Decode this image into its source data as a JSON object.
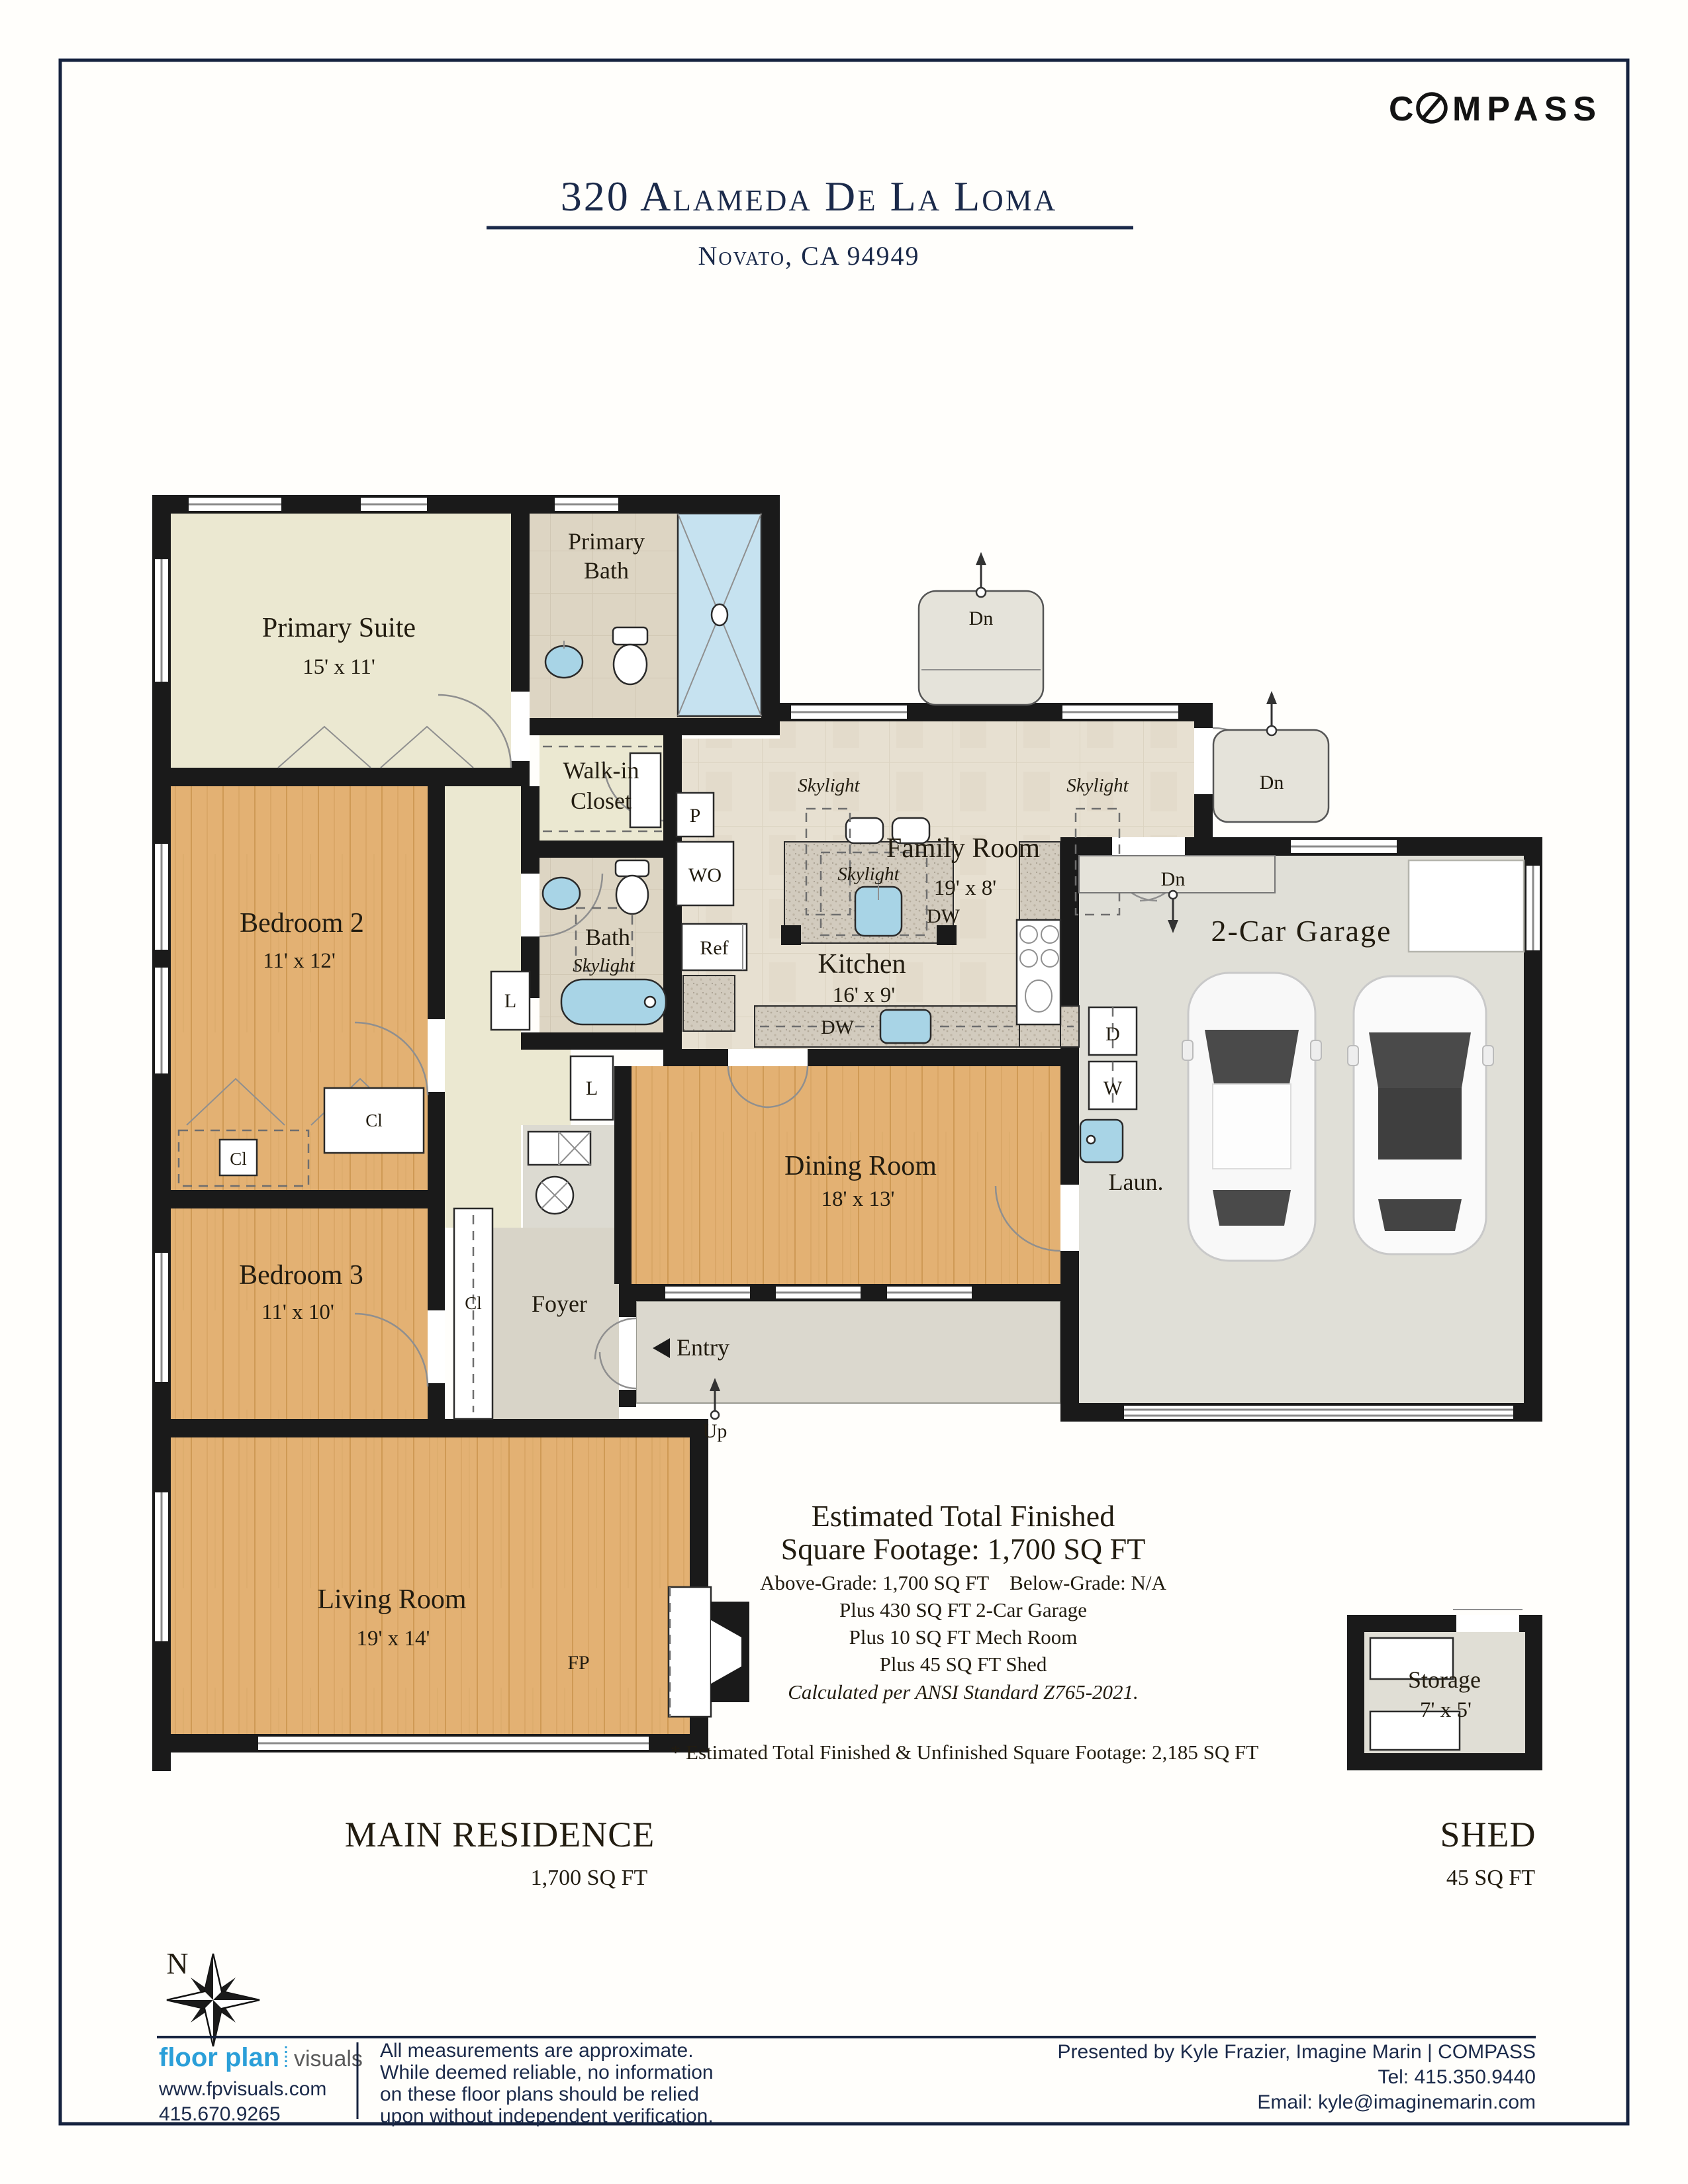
{
  "colors": {
    "navy": "#1b2a4a",
    "wall_black": "#1a1a1a",
    "wood_floor": "#e3b173",
    "cream_floor": "#ebe8d1",
    "tile_floor": "#e7e0d1",
    "bath_tile": "#ddd5c3",
    "granite": "#cfc8bb",
    "fixture_blue": "#a8d4e6",
    "garage_floor": "#e0dfd7",
    "fpv_blue": "#2b9fd8"
  },
  "header": {
    "brand_c": "C",
    "brand_rest": "MPASS",
    "brand_full": "COMPASS",
    "title": "320 Alameda De La Loma",
    "city": "Novato, CA 94949"
  },
  "plan": {
    "rooms": {
      "primary_suite": {
        "label": "Primary Suite",
        "dims": "15' x 11'"
      },
      "primary_bath": {
        "line1": "Primary",
        "line2": "Bath"
      },
      "walkin": {
        "line1": "Walk-in",
        "line2": "Closet"
      },
      "bedroom2": {
        "label": "Bedroom 2",
        "dims": "11' x 12'"
      },
      "bedroom3": {
        "label": "Bedroom 3",
        "dims": "11' x 10'"
      },
      "bath": {
        "label": "Bath"
      },
      "family": {
        "label": "Family Room",
        "dims": "19' x 8'"
      },
      "kitchen": {
        "label": "Kitchen",
        "dims": "16' x 9'"
      },
      "dining": {
        "label": "Dining Room",
        "dims": "18' x 13'"
      },
      "living": {
        "label": "Living Room",
        "dims": "19' x 14'"
      },
      "garage": {
        "label": "2-Car Garage"
      },
      "laundry": {
        "label": "Laun."
      },
      "foyer": {
        "label": "Foyer"
      },
      "entry": {
        "label": "Entry"
      },
      "storage": {
        "label": "Storage",
        "dims": "7' x 5'"
      }
    },
    "markers": {
      "skylight": "Skylight",
      "dn": "Dn",
      "up": "Up",
      "cl": "Cl",
      "l": "L",
      "p": "P",
      "wo": "WO",
      "ref": "Ref",
      "dw": "DW",
      "d": "D",
      "w": "W",
      "fp": "FP",
      "north": "N"
    }
  },
  "summary": {
    "title1": "Estimated Total Finished",
    "title2": "Square Footage: 1,700 SQ FT",
    "grade": "Above-Grade: 1,700 SQ FT Below-Grade: N/A",
    "plus_garage": "Plus 430 SQ FT 2-Car Garage",
    "plus_mech": "Plus 10 SQ FT Mech Room",
    "plus_shed": "Plus 45 SQ FT Shed",
    "ansi": "Calculated per ANSI Standard Z765-2021.",
    "footnote": "* Estimated Total Finished & Unfinished Square Footage: 2,185 SQ FT"
  },
  "sections": {
    "main": "MAIN RESIDENCE",
    "main_sqft": "1,700 SQ FT",
    "shed": "SHED",
    "shed_sqft": "45 SQ FT"
  },
  "footer": {
    "logo_primary": "floor plan",
    "logo_secondary": "visuals",
    "website": "www.fpvisuals.com",
    "phone": "415.670.9265",
    "disclaimer": [
      "All measurements are approximate.",
      "While deemed reliable, no information",
      "on these floor plans should be relied",
      "upon without independent verification."
    ],
    "presented": "Presented by Kyle Frazier, Imagine Marin | COMPASS",
    "tel": "Tel: 415.350.9440",
    "email": "Email: kyle@imaginemarin.com"
  }
}
